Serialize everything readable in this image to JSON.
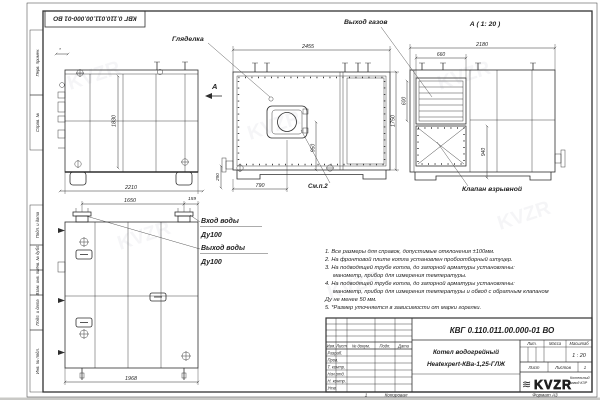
{
  "stamp_top": "КВГ 0.110.011.00.000-01 ВО",
  "frame": {
    "side_labels": [
      "Перв. примен.",
      "Справ. №",
      "Подп. и дата",
      "Инв. № дубл.",
      "Взам. инв. №",
      "Подп. и дата",
      "Инв. № подл."
    ]
  },
  "views": {
    "side": {
      "dim_height": "1830",
      "dim_width": "2210",
      "dim_star": "*"
    },
    "front": {
      "label_sight_glass": "Гляделка",
      "view_arrow_label": "А",
      "dim_width": "2455",
      "dim_height": "1750",
      "dim_burner_v": "950",
      "dim_burner_x": "790",
      "dim_base": "290",
      "see_note": "См.п.2"
    },
    "view_a": {
      "title": "А ( 1: 20 )",
      "label_gas_outlet": "Выход газов",
      "label_explosion_valve": "Клапан взрывной",
      "dim_width": "2180",
      "dim_grid_width": "660",
      "dim_grid_height": "600",
      "dim_valve_height": "940"
    },
    "rear": {
      "dim_flange_span": "1650",
      "dim_flange_offset": "159",
      "dim_width": "1968",
      "label_water_in_1": "Вход воды",
      "label_water_in_2": "Ду100",
      "label_water_out_1": "Выход воды",
      "label_water_out_2": "Ду100"
    }
  },
  "notes": [
    "1. Все размеры для справок, допустимые отклонения ±100мм.",
    "2. На фронтовой плите котла установлен пробоотборный штуцер.",
    "3. На подводящей трубе котла, до запорной арматуры установлены:",
    "манометр, прибор для измерения температуры.",
    "4. На подводящей трубе котла, до запорной арматуры установлены:",
    "манометр, прибор для измерения температуры и обвод с обратным клапаном",
    "Ду не менее 50 мм.",
    "5. *Размер уточняется в зависимости от марки горелки."
  ],
  "titleblock": {
    "doc_number": "КВГ 0.110.011.00.000-01 ВО",
    "product_line1": "Котел водогрейный",
    "product_line2": "Heatexpert-КВа-1,25-ГЛЖ",
    "header_cols": [
      "Изм.",
      "Лист",
      "№ докум.",
      "Подп.",
      "Дата"
    ],
    "sign_rows": [
      "Разраб.",
      "Пров.",
      "Т. контр.",
      "Нач.отд.",
      "Н. контр.",
      "Утв."
    ],
    "right_headers": [
      "Лит.",
      "Масса",
      "Масштаб"
    ],
    "scale_value": "1 : 20",
    "sheet_label": "Лист",
    "sheets_label": "Листов",
    "sheets_value": "1",
    "logo_text": "KVZR",
    "logo_sub_line1": "Котельный",
    "logo_sub_line2": "завод КЗР"
  },
  "footer": {
    "zone_marker": "1",
    "copied_label": "Копировал",
    "format_label": "Формат А3"
  }
}
